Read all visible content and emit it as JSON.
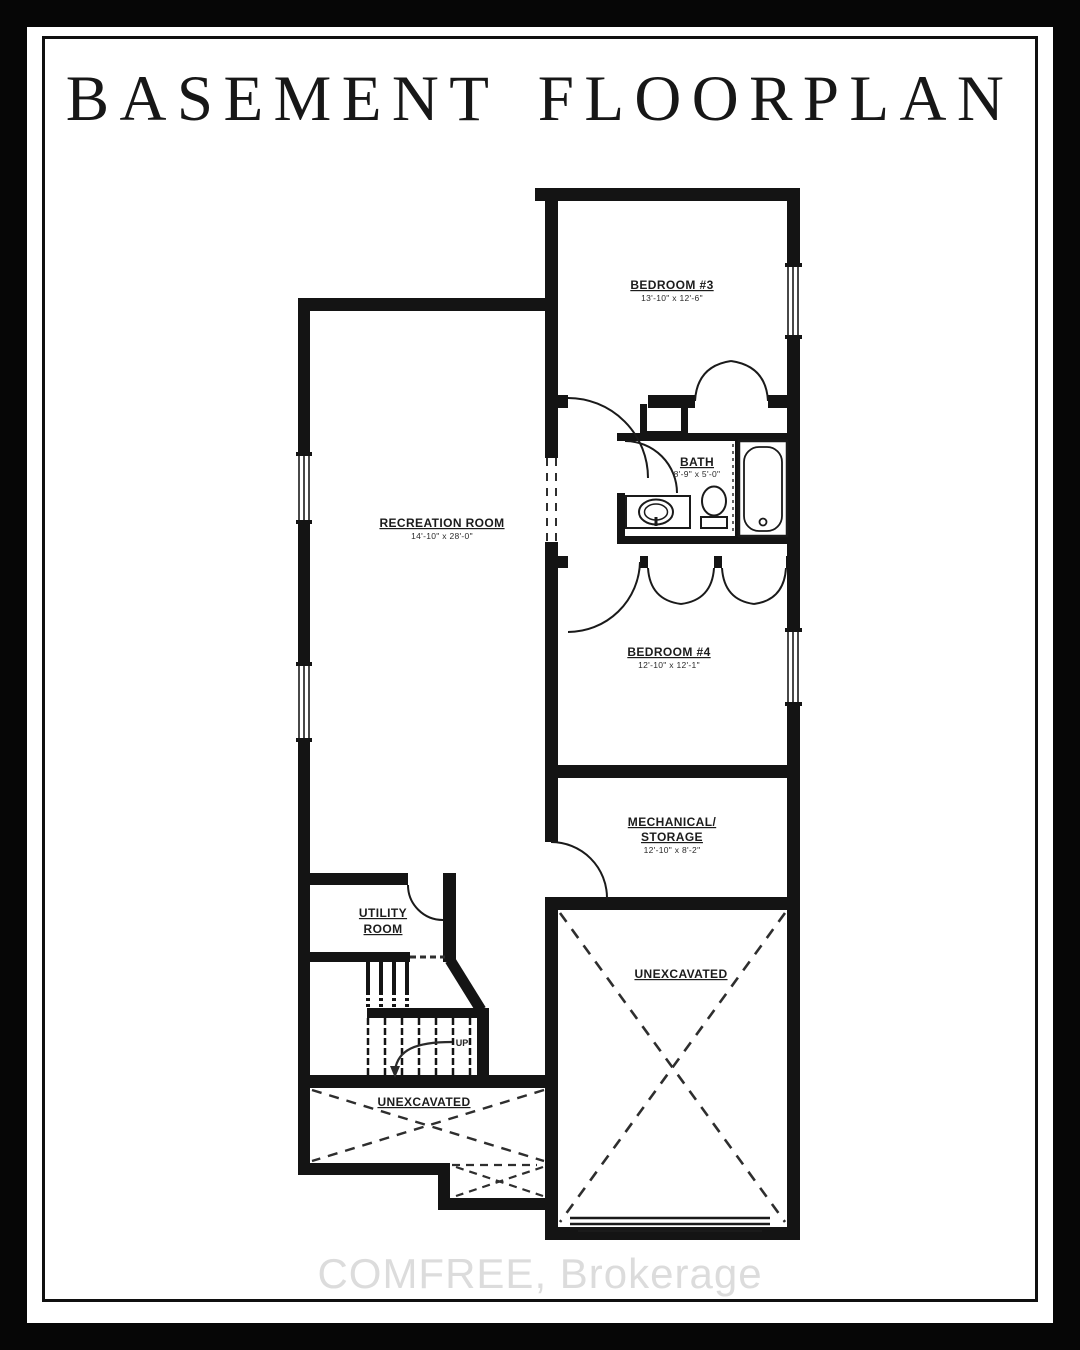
{
  "title": "BASEMENT FLOORPLAN",
  "watermark": "COMFREE, Brokerage",
  "colors": {
    "ink": "#141414",
    "paper": "#ffffff",
    "frame": "#101010",
    "watermark_gray": "#dcdcdc"
  },
  "floorplan": {
    "rooms": [
      {
        "id": "bedroom-3",
        "label": "BEDROOM #3",
        "dims": "13'-10\" x 12'-6\""
      },
      {
        "id": "bath",
        "label": "BATH",
        "dims": "8'-9\" x 5'-0\""
      },
      {
        "id": "recreation-room",
        "label": "RECREATION ROOM",
        "dims": "14'-10\" x 28'-0\""
      },
      {
        "id": "bedroom-4",
        "label": "BEDROOM #4",
        "dims": "12'-10\" x 12'-1\""
      },
      {
        "id": "mechanical-storage",
        "label_line1": "MECHANICAL/",
        "label_line2": "STORAGE",
        "dims": "12'-10\" x 8'-2\""
      },
      {
        "id": "utility-room",
        "label_line1": "UTILITY",
        "label_line2": "ROOM"
      },
      {
        "id": "unexcavated-rear",
        "label": "UNEXCAVATED"
      },
      {
        "id": "unexcavated-front",
        "label": "UNEXCAVATED"
      }
    ],
    "stairs": {
      "direction_label": "UP"
    }
  }
}
